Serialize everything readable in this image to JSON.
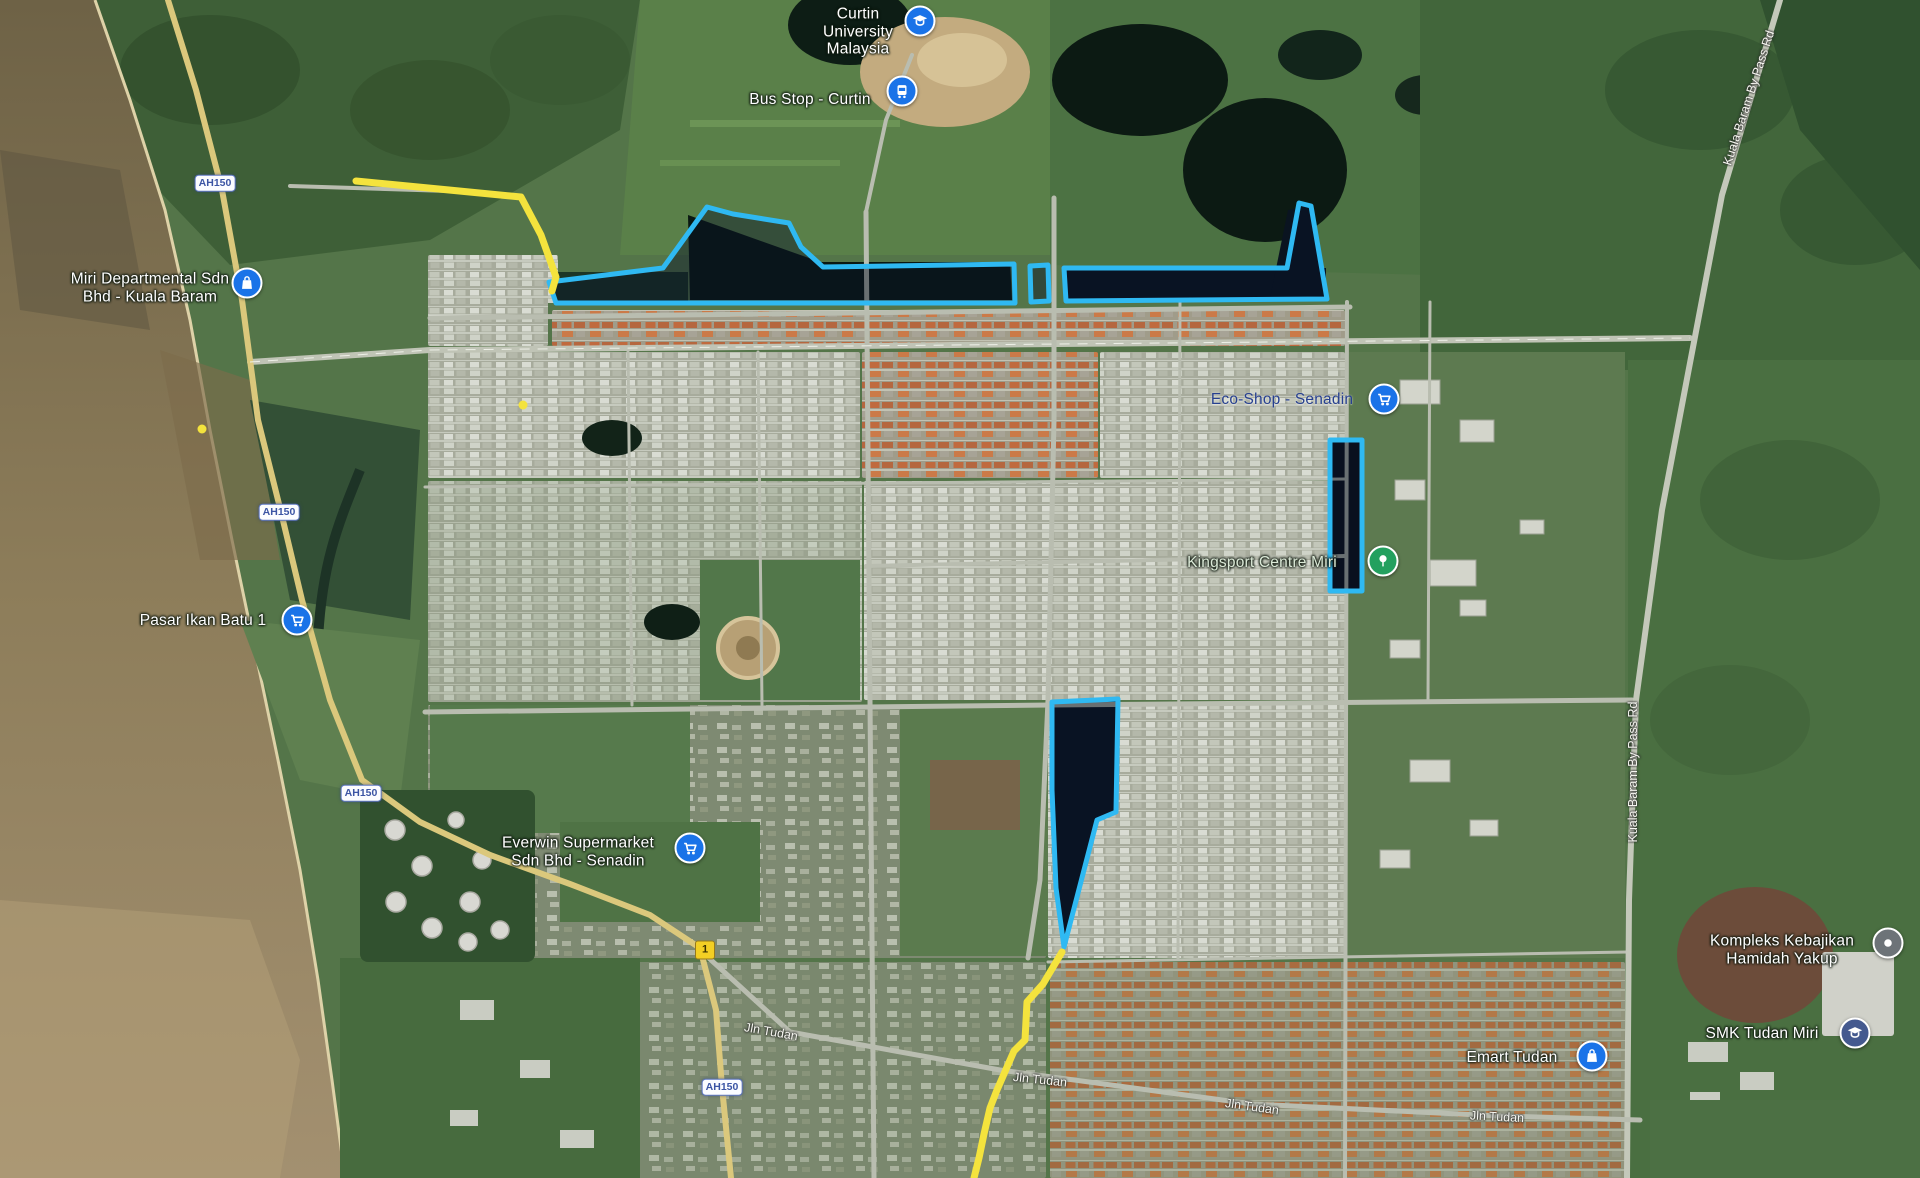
{
  "map": {
    "pois": [
      {
        "name": "curtin-university-malaysia",
        "lines": [
          "Curtin",
          "University",
          "Malaysia"
        ],
        "label": {
          "x": 858,
          "y": 32
        },
        "text_color": "#ffffff",
        "pin": {
          "x": 920,
          "y": 21,
          "color": "#1a73e8",
          "icon": "graduation-cap-icon"
        }
      },
      {
        "name": "bus-stop-curtin",
        "lines": [
          "Bus Stop - Curtin"
        ],
        "label": {
          "x": 810,
          "y": 100
        },
        "text_color": "#ffffff",
        "pin": {
          "x": 902,
          "y": 91,
          "color": "#1a73e8",
          "icon": "bus-icon"
        }
      },
      {
        "name": "miri-departmental-sdn-bhd-kuala-baram",
        "lines": [
          "Miri Departmental Sdn",
          "Bhd - Kuala Baram"
        ],
        "label": {
          "x": 150,
          "y": 288
        },
        "text_color": "#ffffff",
        "pin": {
          "x": 247,
          "y": 283,
          "color": "#1a73e8",
          "icon": "shopping-bag-icon"
        }
      },
      {
        "name": "pasar-ikan-batu-1",
        "lines": [
          "Pasar Ikan Batu 1"
        ],
        "label": {
          "x": 203,
          "y": 621
        },
        "text_color": "#ffffff",
        "pin": {
          "x": 297,
          "y": 620,
          "color": "#1a73e8",
          "icon": "shopping-cart-icon"
        }
      },
      {
        "name": "everwin-supermarket-sdn-bhd-senadin",
        "lines": [
          "Everwin Supermarket",
          "Sdn Bhd - Senadin"
        ],
        "label": {
          "x": 578,
          "y": 852
        },
        "text_color": "#ffffff",
        "pin": {
          "x": 690,
          "y": 848,
          "color": "#1a73e8",
          "icon": "shopping-cart-icon"
        }
      },
      {
        "name": "eco-shop-senadin",
        "lines": [
          "Eco-Shop - Senadin"
        ],
        "label": {
          "x": 1282,
          "y": 400
        },
        "text_color": "#27408f",
        "pin": {
          "x": 1384,
          "y": 399,
          "color": "#1a73e8",
          "icon": "shopping-cart-icon"
        }
      },
      {
        "name": "kingsport-centre-miri",
        "lines": [
          "Kingsport Centre Miri"
        ],
        "label": {
          "x": 1262,
          "y": 563
        },
        "text_color": "#dcead8",
        "pin": {
          "x": 1383,
          "y": 561,
          "color": "#23a05f",
          "icon": "tree-icon"
        }
      },
      {
        "name": "kompleks-kebajikan-hamidah-yakup",
        "lines": [
          "Kompleks Kebajikan",
          "Hamidah Yakup"
        ],
        "label": {
          "x": 1782,
          "y": 950
        },
        "text_color": "#ffffff",
        "pin": {
          "x": 1888,
          "y": 943,
          "color": "#6d7378",
          "icon": "dot-icon"
        }
      },
      {
        "name": "smk-tudan-miri",
        "lines": [
          "SMK Tudan Miri"
        ],
        "label": {
          "x": 1762,
          "y": 1034
        },
        "text_color": "#ffffff",
        "pin": {
          "x": 1855,
          "y": 1033,
          "color": "#44598f",
          "icon": "graduation-cap-icon"
        }
      },
      {
        "name": "emart-tudan",
        "lines": [
          "Emart Tudan"
        ],
        "label": {
          "x": 1512,
          "y": 1058
        },
        "text_color": "#ffffff",
        "pin": {
          "x": 1592,
          "y": 1056,
          "color": "#1a73e8",
          "icon": "shopping-bag-icon"
        }
      }
    ],
    "road_shields": [
      {
        "text": "AH150",
        "x": 215,
        "y": 183,
        "style": "highway"
      },
      {
        "text": "AH150",
        "x": 279,
        "y": 512,
        "style": "highway"
      },
      {
        "text": "AH150",
        "x": 361,
        "y": 793,
        "style": "highway"
      },
      {
        "text": "AH150",
        "x": 722,
        "y": 1087,
        "style": "highway"
      },
      {
        "text": "1",
        "x": 705,
        "y": 950,
        "style": "route"
      }
    ],
    "road_labels": [
      {
        "text": "Jln Tudan",
        "x": 771,
        "y": 1032,
        "rot": 10
      },
      {
        "text": "Jln Tudan",
        "x": 1040,
        "y": 1080,
        "rot": 6
      },
      {
        "text": "Jln Tudan",
        "x": 1252,
        "y": 1107,
        "rot": 8
      },
      {
        "text": "Jln Tudan",
        "x": 1497,
        "y": 1117,
        "rot": 3
      },
      {
        "text": "Kuala Baram By Pass Rd",
        "x": 1633,
        "y": 772,
        "rot": -90
      },
      {
        "text": "Kuala Baram By Pass Rd",
        "x": 1749,
        "y": 98,
        "rot": -72
      }
    ],
    "highlights": {
      "stroke_color": "#2fb9f2",
      "fill_color": "#081228",
      "fill_opacity": 0.45,
      "stroke_width": 5,
      "polygons": [
        {
          "name": "highlight-area-1",
          "points": [
            [
              549,
              282
            ],
            [
              663,
              268
            ],
            [
              671,
              257
            ],
            [
              707,
              207
            ],
            [
              733,
              214
            ],
            [
              789,
              223
            ],
            [
              801,
              247
            ],
            [
              823,
              267
            ],
            [
              1014,
              264
            ],
            [
              1015,
              303
            ],
            [
              556,
              303
            ]
          ]
        },
        {
          "name": "highlight-area-1b",
          "points": [
            [
              1030,
              266
            ],
            [
              1048,
              265
            ],
            [
              1049,
              301
            ],
            [
              1031,
              302
            ]
          ]
        },
        {
          "name": "highlight-area-2",
          "points": [
            [
              1064,
              268
            ],
            [
              1287,
              268
            ],
            [
              1299,
              203
            ],
            [
              1311,
              206
            ],
            [
              1327,
              299
            ],
            [
              1066,
              301
            ]
          ]
        },
        {
          "name": "highlight-area-3",
          "points": [
            [
              1330,
              440
            ],
            [
              1362,
              440
            ],
            [
              1362,
              591
            ],
            [
              1330,
              591
            ]
          ]
        },
        {
          "name": "highlight-area-4",
          "points": [
            [
              1052,
              702
            ],
            [
              1118,
              699
            ],
            [
              1116,
              812
            ],
            [
              1097,
              820
            ],
            [
              1064,
              947
            ],
            [
              1056,
              888
            ],
            [
              1052,
              790
            ]
          ]
        }
      ]
    },
    "routes": {
      "color": "#f4e33d",
      "width": 7,
      "polylines": [
        {
          "name": "route-segment-north",
          "points": [
            [
              356,
              181
            ],
            [
              449,
              190
            ],
            [
              521,
              197
            ],
            [
              541,
              235
            ],
            [
              556,
              277
            ],
            [
              552,
              291
            ]
          ]
        },
        {
          "name": "route-segment-south",
          "points": [
            [
              1062,
              952
            ],
            [
              1043,
              984
            ],
            [
              1027,
              1002
            ],
            [
              1025,
              1040
            ],
            [
              1014,
              1051
            ],
            [
              997,
              1090
            ],
            [
              990,
              1108
            ],
            [
              984,
              1134
            ],
            [
              979,
              1158
            ],
            [
              974,
              1178
            ]
          ]
        }
      ],
      "dots": [
        [
          523,
          405
        ],
        [
          202,
          429
        ]
      ]
    }
  }
}
